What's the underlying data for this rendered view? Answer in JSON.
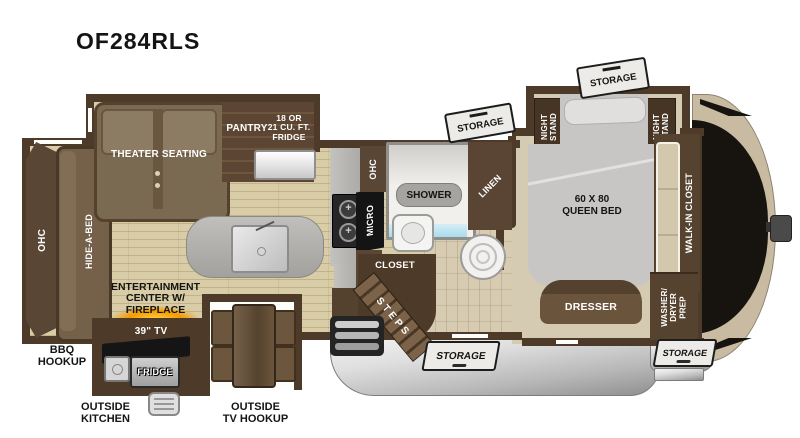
{
  "title": "OF284RLS",
  "colors": {
    "wall_brown": "#4d3a29",
    "cabinet_brown": "#5c4633",
    "floor_tan": "#d9cda7",
    "carpet_tan": "#d5cab2",
    "counter_gray": "#b3b2ae",
    "bed_gray": "#c7c6c4",
    "shower_blue": "#a9dcec",
    "fireplace_orange": "#f59b00",
    "basement_silver": "#c9c9c9",
    "cap_black": "#17130e",
    "cap_tan": "#c8bba1"
  },
  "plan": {
    "living": {
      "theater_seating": "THEATER SEATING",
      "pantry": "PANTRY",
      "fridge": "18 OR\n21 CU. FT.\nFRIDGE",
      "ohc_rear": "OHC",
      "hide_a_bed": "HIDE-A-BED",
      "entertainment_center": "ENTERTAINMENT\nCENTER W/\nFIREPLACE",
      "tv": "39\" TV",
      "outside_kitchen_fridge": "FRIDGE"
    },
    "kitchen": {
      "ohc_upper": "OHC",
      "micro": "MICRO",
      "ohc_lower": "OHC"
    },
    "bath": {
      "shower": "SHOWER",
      "linen": "LINEN",
      "closet": "CLOSET",
      "steps": "STEPS"
    },
    "bedroom": {
      "night_stand_left": "NIGHT\nSTAND",
      "night_stand_right": "NIGHT\nSTAND",
      "queen_bed": "60 X 80\nQUEEN BED",
      "dresser": "DRESSER",
      "walk_in_closet": "WALK-IN CLOSET",
      "washer_dryer_prep": "WASHER/\nDRYER\nPREP"
    },
    "exterior": {
      "storage_flag_bath": "STORAGE",
      "storage_flag_bedroom": "STORAGE",
      "storage_door_main": "STORAGE",
      "storage_door_front": "STORAGE",
      "bbq_hookup": "BBQ\nHOOKUP",
      "outside_kitchen": "OUTSIDE\nKITCHEN",
      "outside_tv_hookup": "OUTSIDE\nTV HOOKUP"
    }
  }
}
